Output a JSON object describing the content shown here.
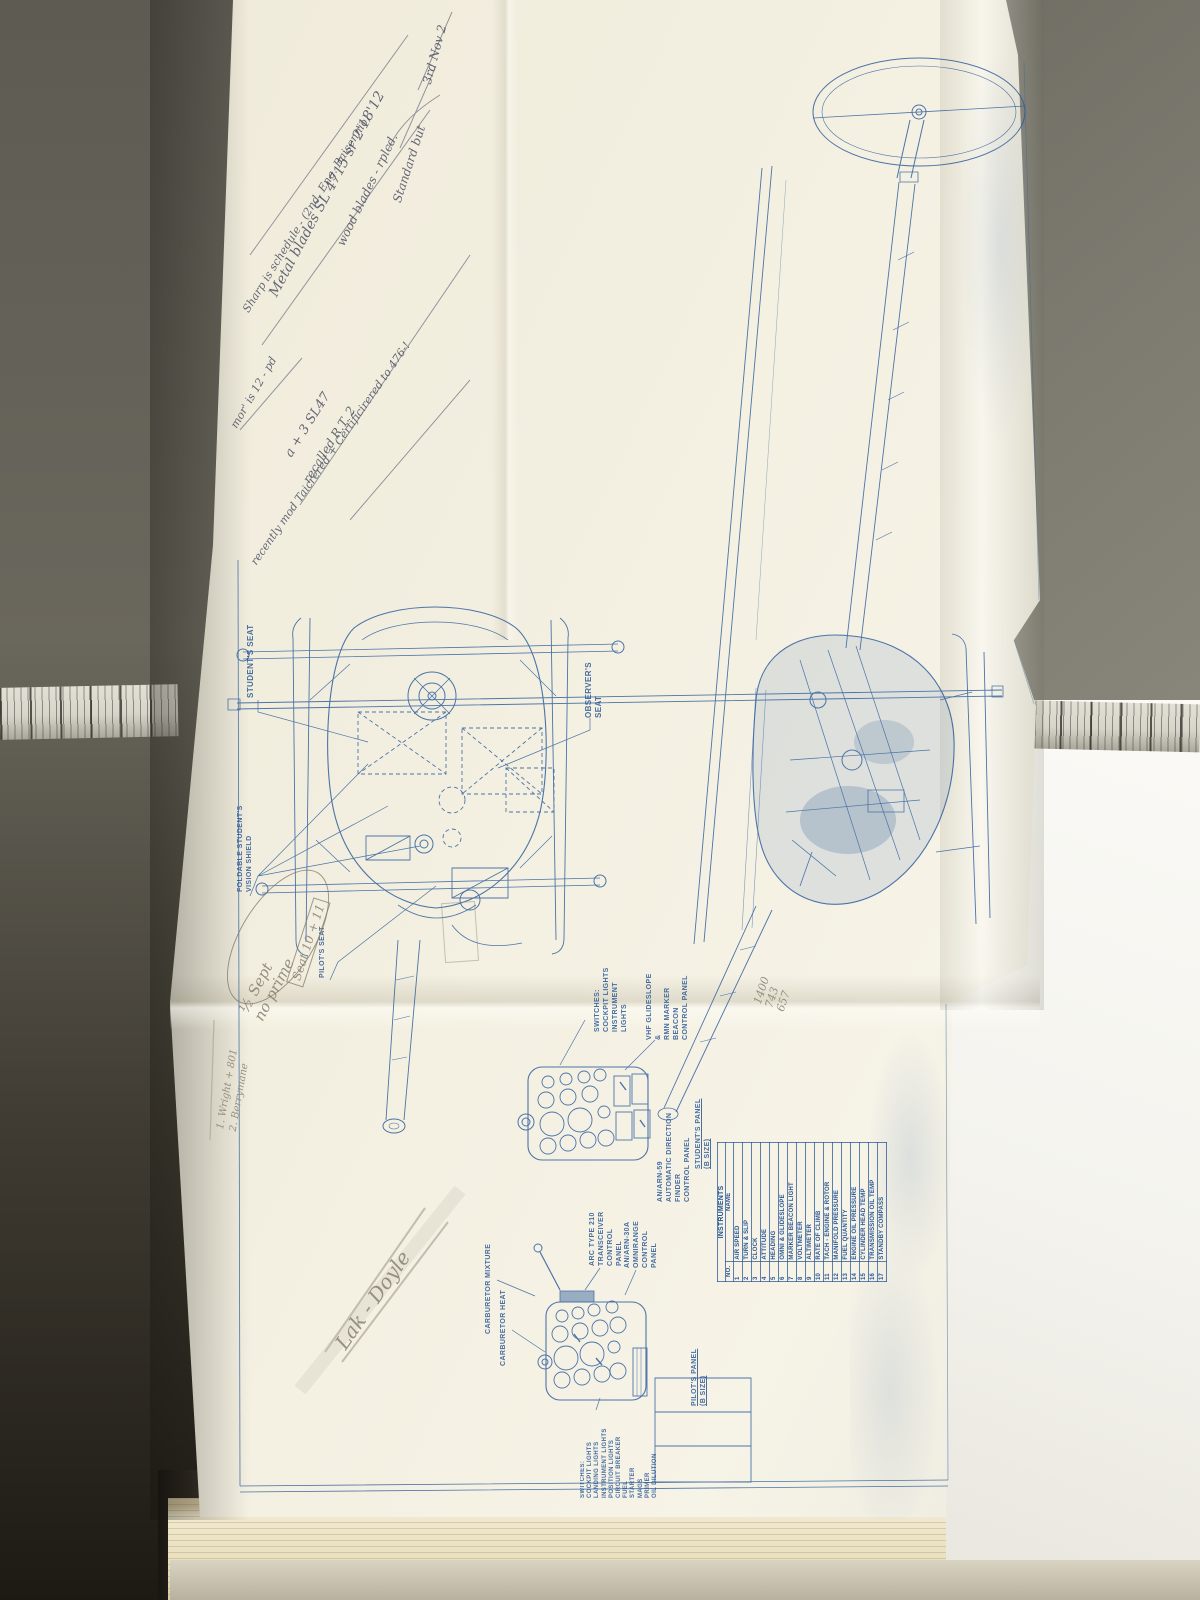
{
  "colors": {
    "blueprint_blue": "#2d5d9c",
    "paper_cream": "#f1ecdc",
    "wall_gray": "#6b695f",
    "pencil_gray": "#8d8676",
    "pen_blue": "#4b5063",
    "book_page": "#ece4c6"
  },
  "blueprint": {
    "printed_labels": {
      "students_seat": "STUDENT'S SEAT",
      "observers_seat": "OBSERVER'S SEAT",
      "foldable_shield": "FOLDABLE STUDENT'S\nVISION SHIELD",
      "pilots_seat": "PILOT'S SEAT",
      "switches_student": "SWITCHES:\nCOCKPIT LIGHTS\nINSTRUMENT LIGHTS",
      "glideslope_panel": "VHF GLIDESLOPE &\nRMN MARKER BEACON\nCONTROL PANEL",
      "adf_panel": "AN/ARN-59\nAUTOMATIC DIRECTION FINDER\nCONTROL PANEL",
      "students_panel": "STUDENT'S PANEL\n(B SIZE)",
      "arc_panel": "ARC TYPE 210\nTRANSCEIVER\nCONTROL PANEL",
      "omnirange_panel": "AN/ARN-30A\nOMNIRANGE\nCONTROL PANEL",
      "pilots_panel": "PILOT'S PANEL\n(B SIZE)",
      "carb_mixture": "CARBURETOR MIXTURE",
      "carb_heat": "CARBURETOR HEAT",
      "switches_pilot": "SWITCHES:\nCOCKPIT LIGHTS\nLANDING LIGHTS\nINSTRUMENT LIGHTS\nPOSITION LIGHTS\nCIRCUIT BREAKER\nFUEL\nSTARTER\nMAGS\nPRIMER\nOIL DILUTION"
    },
    "instruments_table": {
      "title": "INSTRUMENTS",
      "columns": [
        "NO.",
        "NAME"
      ],
      "rows": [
        [
          "1",
          "AIR SPEED"
        ],
        [
          "2",
          "TURN & SLIP"
        ],
        [
          "3",
          "CLOCK"
        ],
        [
          "4",
          "ATTITUDE"
        ],
        [
          "5",
          "HEADING"
        ],
        [
          "6",
          "OMNI & GLIDESLOPE"
        ],
        [
          "7",
          "MARKER BEACON LIGHT"
        ],
        [
          "8",
          "VOLTMETER"
        ],
        [
          "9",
          "ALTIMETER"
        ],
        [
          "10",
          "RATE OF CLIMB"
        ],
        [
          "11",
          "TACH - ENGINE & ROTOR"
        ],
        [
          "12",
          "MANIFOLD PRESSURE"
        ],
        [
          "13",
          "FUEL QUANTITY"
        ],
        [
          "14",
          "ENGINE OIL PRESSURE"
        ],
        [
          "15",
          "CYLINDER HEAD TEMP"
        ],
        [
          "16",
          "TRANSMISSION OIL TEMP"
        ],
        [
          "17",
          "STANDBY COMPASS"
        ]
      ]
    },
    "handwritten": {
      "note_nov": "3rd Nov 2",
      "note_standard": "Standard but",
      "note_metal": "Metal blades SL 4715 sr 2'18'12",
      "note_wood": "wood blades - rplcd.",
      "note_sharp": "Sharp is schedule - (2nd. Eng. Baisennio)",
      "note_mor": "mor' is 12 - pd",
      "note_recent": "recently mod Taicrered + Certificirered to 476-!",
      "note_sl47": "a + 3 SL47",
      "note_recalled": "recalled R.T. 2",
      "note_seat": "Seat 10 + 11",
      "note_sept": "½ Sept\nno prime",
      "note_names": "1. Wright + 801\n2. Berrymane",
      "note_lak": "Lak - Doyle",
      "note_calc": "1400\n743\n657"
    }
  }
}
